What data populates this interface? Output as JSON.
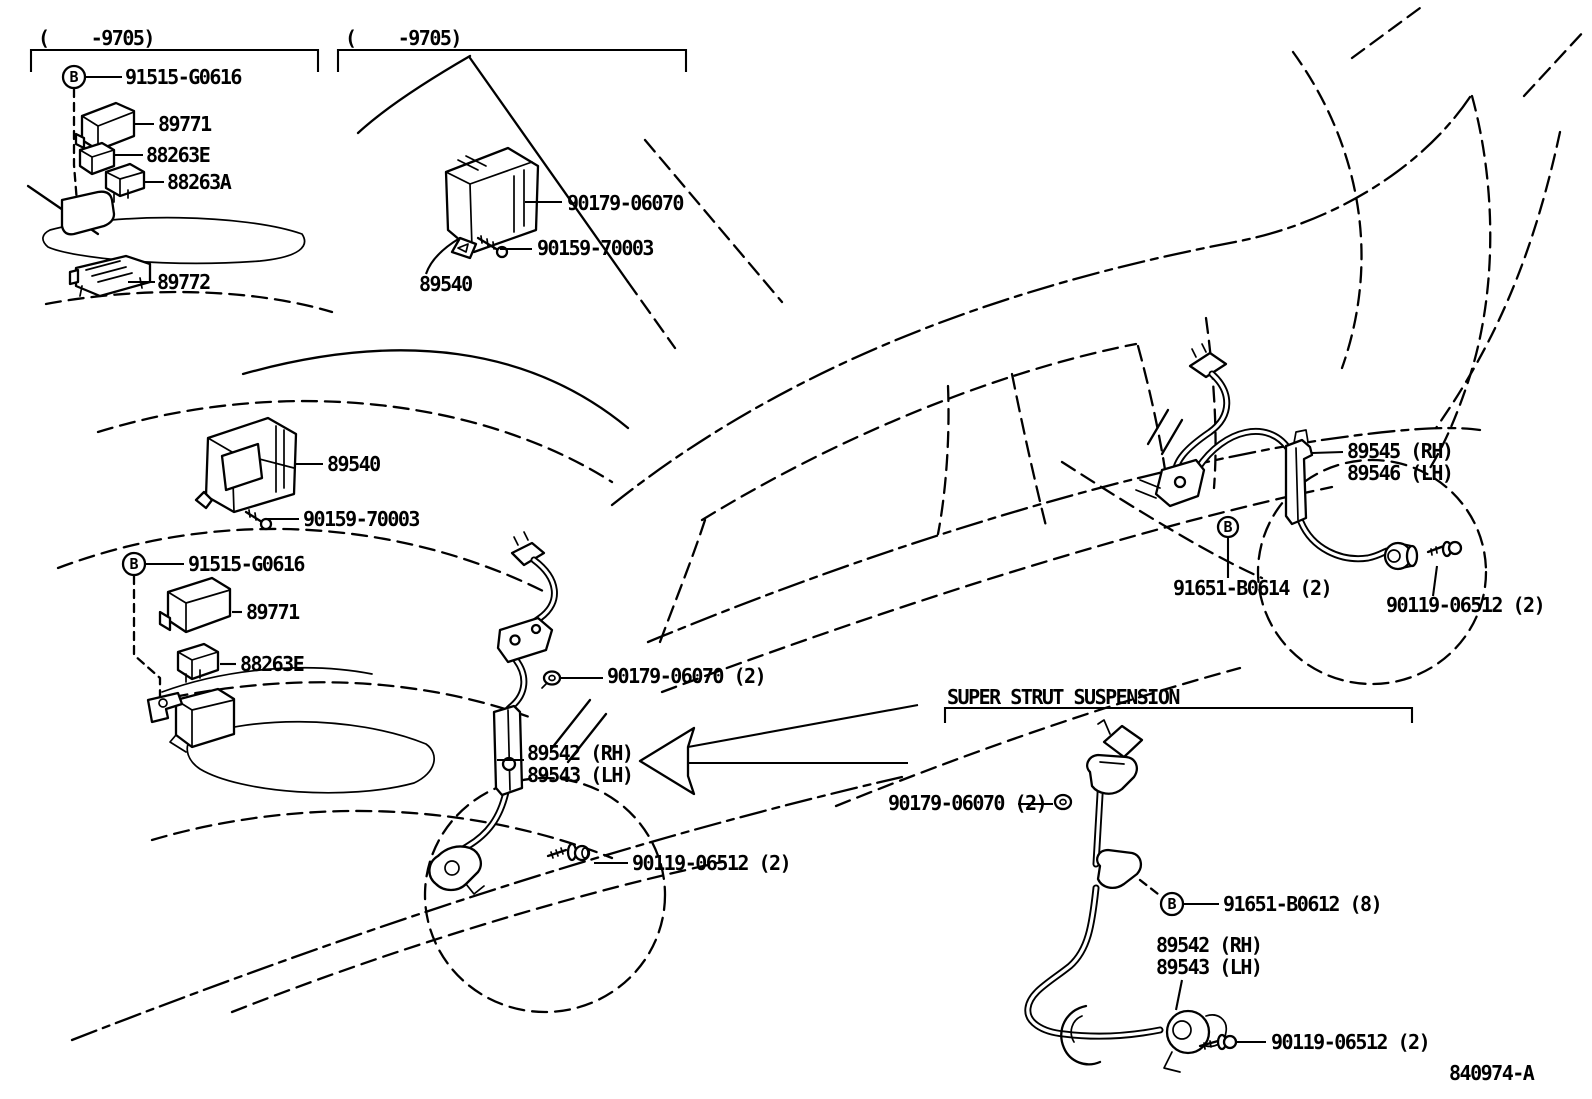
{
  "drawing": {
    "number": "840974-A",
    "symbol_b": "B"
  },
  "sections": {
    "early_relays": {
      "range": "(    -9705)",
      "fastener": "91515-G0616",
      "relay_a": "89771",
      "relay_b": "88263E",
      "relay_c": "88263A",
      "bracket": "89772"
    },
    "early_ecu": {
      "range": "(    -9705)",
      "grommet_screw": "90179-06070",
      "screw": "90159-70003",
      "computer": "89540"
    },
    "main_ecu": {
      "computer": "89540",
      "screw": "90159-70003",
      "fastener": "91515-G0616",
      "relay_a": "89771",
      "relay_b": "88263E"
    },
    "front_sensor": {
      "grommet_screw": "90179-06070 (2)",
      "sensor_rh": "89542 (RH)",
      "sensor_lh": "89543 (LH)",
      "bolt": "90119-06512 (2)"
    },
    "rear_sensor": {
      "sensor_rh": "89545 (RH)",
      "sensor_lh": "89546 (LH)",
      "clip_bolt": "91651-B0614 (2)",
      "bolt": "90119-06512 (2)"
    },
    "super_strut": {
      "heading": "SUPER STRUT SUSPENSION",
      "grommet_screw": "90179-06070 (2)",
      "clip_bolt": "91651-B0612 (8)",
      "sensor_rh": "89542 (RH)",
      "sensor_lh": "89543 (LH)",
      "bolt": "90119-06512 (2)"
    }
  }
}
